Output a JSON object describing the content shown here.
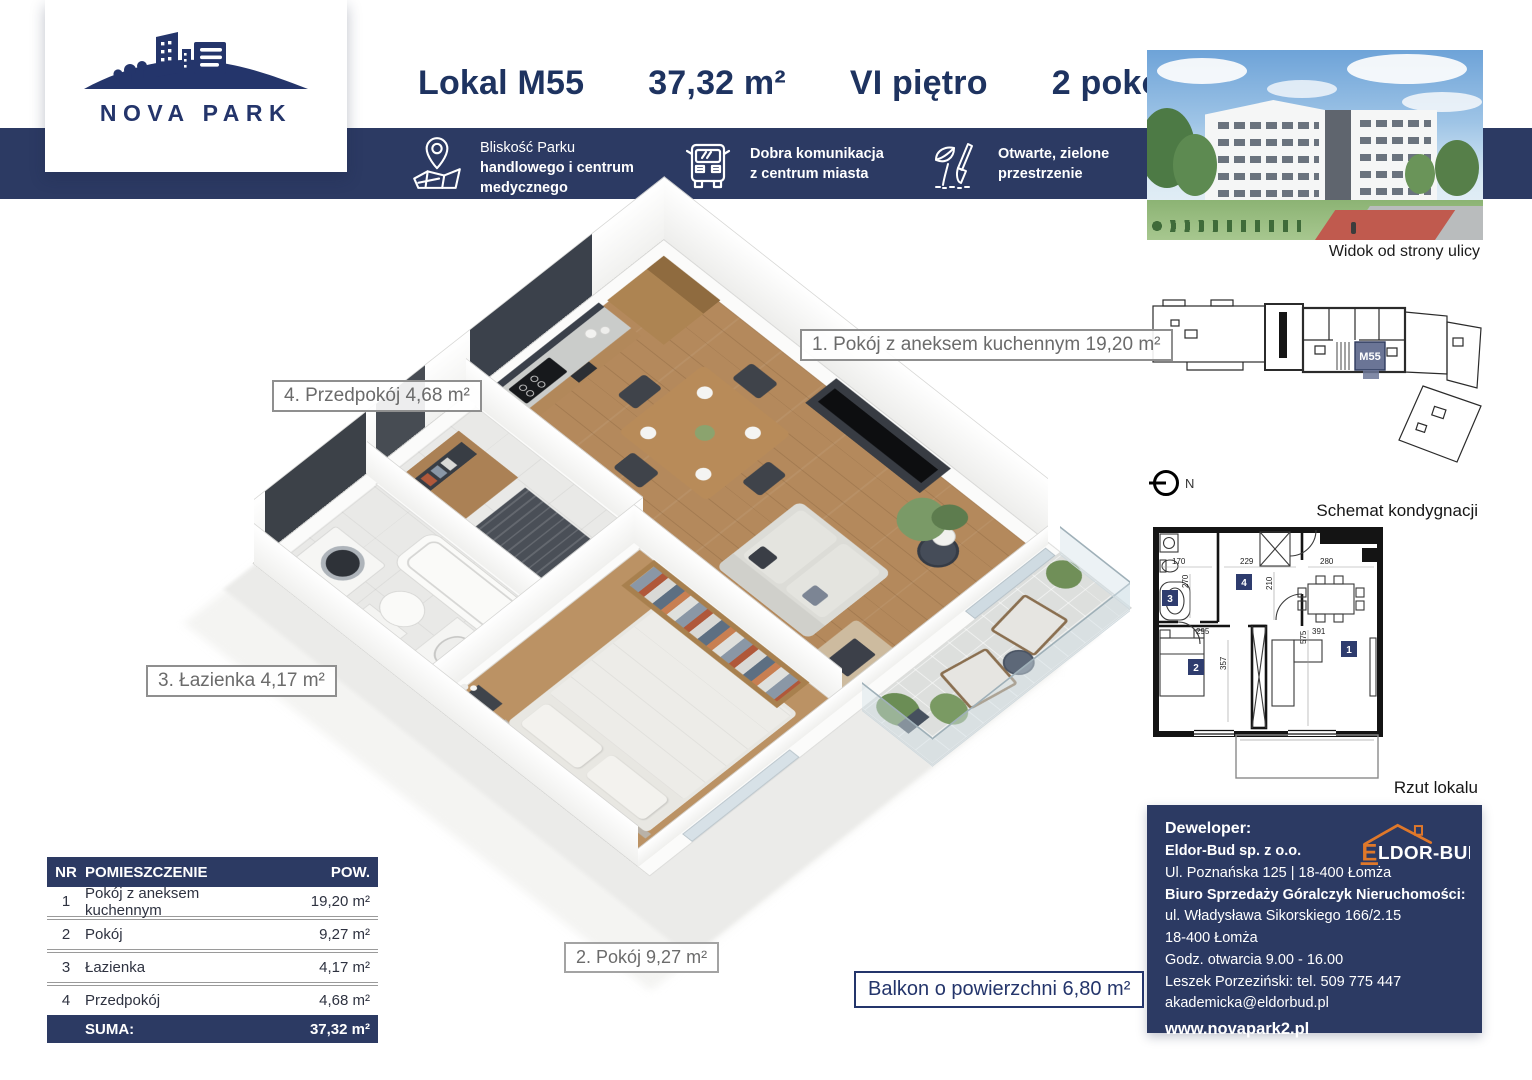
{
  "logo": {
    "brand": "NOVA PARK"
  },
  "header": {
    "unit": "Lokal M55",
    "area": "37,32 m²",
    "floor": "VI piętro",
    "rooms": "2 pokoje"
  },
  "features": {
    "f1_l1": "Bliskość Parku",
    "f1_l2": "handlowego i centrum",
    "f1_l3": "medycznego",
    "f2_l1": "Dobra komunikacja",
    "f2_l2": "z centrum miasta",
    "f3_l1": "Otwarte, zielone",
    "f3_l2": "przestrzenie"
  },
  "photo": {
    "caption": "Widok od strony ulicy"
  },
  "schematic": {
    "caption": "Schemat kondygnacji",
    "unit_tag": "M55",
    "compass_label": "N"
  },
  "rzut": {
    "caption": "Rzut lokalu",
    "tiles": {
      "t1": "1",
      "t2": "2",
      "t3": "3",
      "t4": "4"
    },
    "dims": {
      "d170": "170",
      "d229": "229",
      "d280": "280",
      "d270": "270",
      "d210": "210",
      "d295": "295",
      "d575": "575",
      "d391": "391",
      "d357": "357"
    }
  },
  "plan3d": {
    "label_living": "1. Pokój z aneksem kuchennym 19,20 m²",
    "label_hall": "4. Przedpokój 4,68 m²",
    "label_bath": "3. Łazienka 4,17 m²",
    "label_room": "2. Pokój 9,27 m²",
    "label_balcony": "Balkon o powierzchni 6,80 m²"
  },
  "table": {
    "headers": {
      "nr": "NR",
      "name": "POMIESZCZENIE",
      "area": "POW."
    },
    "rows": [
      {
        "nr": "1",
        "name": "Pokój z aneksem kuchennym",
        "area": "19,20 m²"
      },
      {
        "nr": "2",
        "name": "Pokój",
        "area": "9,27 m²"
      },
      {
        "nr": "3",
        "name": "Łazienka",
        "area": "4,17 m²"
      },
      {
        "nr": "4",
        "name": "Przedpokój",
        "area": "4,68 m²"
      }
    ],
    "sum_label": "SUMA:",
    "sum_value": "37,32 m²"
  },
  "developer": {
    "heading": "Deweloper:",
    "company": "Eldor-Bud sp. z o.o.",
    "address": "Ul. Poznańska 125 | 18-400 Łomża",
    "office": "Biuro Sprzedaży Góralczyk Nieruchomości:",
    "line1": "ul. Władysława Sikorskiego 166/2.15",
    "line2": "18-400 Łomża",
    "line3": "Godz. otwarcia 9.00 - 16.00",
    "line4": "Leszek Porzeziński: tel. 509 775 447",
    "line5": "akademicka@eldorbud.pl",
    "website": "www.novapark2.pl",
    "logo_text": "LDOR-BUD",
    "logo_initial": "E"
  },
  "colors": {
    "navy": "#2c3a63",
    "navy_text": "#1e3360",
    "orange": "#e0782a"
  }
}
